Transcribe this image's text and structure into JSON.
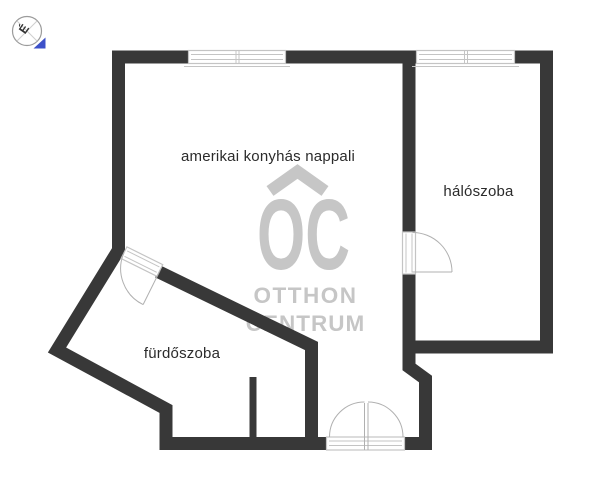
{
  "rooms": {
    "living": {
      "label": "amerikai konyhás nappali"
    },
    "bedroom": {
      "label": "hálószoba"
    },
    "bathroom": {
      "label": "fürdőszoba"
    }
  },
  "watermark": {
    "initials": "OC",
    "line1": "OTTHON",
    "line2": "CENTRUM"
  },
  "compass": {
    "north_letter": "É"
  },
  "colors": {
    "wall": "#383838",
    "frame": "#c4c4c4",
    "label": "#2b2b2b",
    "watermark": "#c6c6c6",
    "blue": "#3d51c9"
  }
}
